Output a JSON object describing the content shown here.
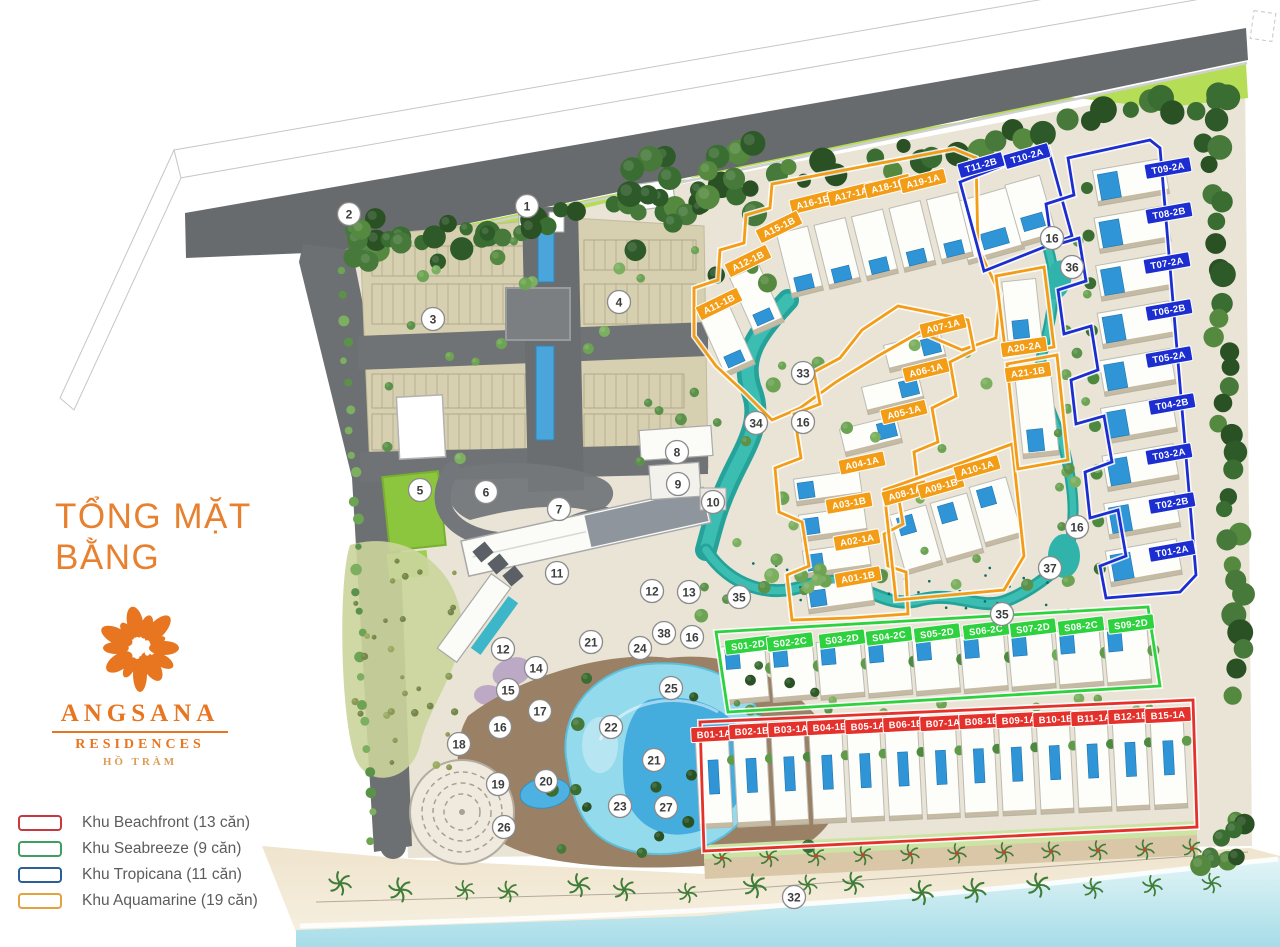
{
  "panel": {
    "title_lines": [
      "TỔNG MẶT",
      "BẰNG"
    ],
    "title_color": "#e8812f",
    "brand": {
      "name": "ANGSANA",
      "type": "RESIDENCES",
      "location": "HỒ TRÀM",
      "color": "#e8751f",
      "location_color": "#dd9c55"
    },
    "legend": [
      {
        "zone": "beachfront",
        "label": "Khu Beachfront (13 căn)",
        "color": "#c43a40"
      },
      {
        "zone": "seabreeze",
        "label": "Khu Seabreeze (9 căn)",
        "color": "#3f9e63"
      },
      {
        "zone": "tropicana",
        "label": "Khu Tropicana (11 căn)",
        "color": "#2d5f96"
      },
      {
        "zone": "aquamarine",
        "label": "Khu Aquamarine (19 căn)",
        "color": "#e2a23e"
      }
    ]
  },
  "map": {
    "zone_colors": {
      "beachfront": "#e5312b",
      "seabreeze": "#2ed13e",
      "tropicana": "#1c2ed0",
      "aquamarine": "#f39c15"
    },
    "units": [
      {
        "id": "A16-1B",
        "zone": "aquamarine",
        "x": 813,
        "y": 202,
        "r": -14
      },
      {
        "id": "A17-1A",
        "zone": "aquamarine",
        "x": 851,
        "y": 194,
        "r": -14
      },
      {
        "id": "A18-1B",
        "zone": "aquamarine",
        "x": 888,
        "y": 186,
        "r": -14
      },
      {
        "id": "A19-1A",
        "zone": "aquamarine",
        "x": 923,
        "y": 181,
        "r": -14
      },
      {
        "id": "A15-1B",
        "zone": "aquamarine",
        "x": 779,
        "y": 227,
        "r": -26
      },
      {
        "id": "A12-1B",
        "zone": "aquamarine",
        "x": 748,
        "y": 261,
        "r": -26
      },
      {
        "id": "A11-1B",
        "zone": "aquamarine",
        "x": 719,
        "y": 304,
        "r": -26
      },
      {
        "id": "A07-1A",
        "zone": "aquamarine",
        "x": 943,
        "y": 326,
        "r": -14
      },
      {
        "id": "A06-1A",
        "zone": "aquamarine",
        "x": 926,
        "y": 370,
        "r": -14
      },
      {
        "id": "A05-1A",
        "zone": "aquamarine",
        "x": 904,
        "y": 412,
        "r": -14
      },
      {
        "id": "A04-1A",
        "zone": "aquamarine",
        "x": 862,
        "y": 463,
        "r": -12
      },
      {
        "id": "A03-1B",
        "zone": "aquamarine",
        "x": 849,
        "y": 503,
        "r": -10
      },
      {
        "id": "A02-1A",
        "zone": "aquamarine",
        "x": 857,
        "y": 540,
        "r": -10
      },
      {
        "id": "A01-1B",
        "zone": "aquamarine",
        "x": 858,
        "y": 577,
        "r": -10
      },
      {
        "id": "A08-1A",
        "zone": "aquamarine",
        "x": 905,
        "y": 493,
        "r": -16
      },
      {
        "id": "A09-1B",
        "zone": "aquamarine",
        "x": 941,
        "y": 486,
        "r": -16
      },
      {
        "id": "A10-1A",
        "zone": "aquamarine",
        "x": 977,
        "y": 468,
        "r": -16
      },
      {
        "id": "A20-2A",
        "zone": "aquamarine",
        "x": 1024,
        "y": 347,
        "r": -8
      },
      {
        "id": "A21-1B",
        "zone": "aquamarine",
        "x": 1028,
        "y": 372,
        "r": -8
      },
      {
        "id": "T11-2B",
        "zone": "tropicana",
        "x": 981,
        "y": 165,
        "r": -16
      },
      {
        "id": "T10-2A",
        "zone": "tropicana",
        "x": 1027,
        "y": 156,
        "r": -16
      },
      {
        "id": "T09-2A",
        "zone": "tropicana",
        "x": 1168,
        "y": 168,
        "r": -10
      },
      {
        "id": "T08-2B",
        "zone": "tropicana",
        "x": 1169,
        "y": 213,
        "r": -10
      },
      {
        "id": "T07-2A",
        "zone": "tropicana",
        "x": 1167,
        "y": 263,
        "r": -10
      },
      {
        "id": "T06-2B",
        "zone": "tropicana",
        "x": 1169,
        "y": 310,
        "r": -10
      },
      {
        "id": "T05-2A",
        "zone": "tropicana",
        "x": 1169,
        "y": 357,
        "r": -10
      },
      {
        "id": "T04-2B",
        "zone": "tropicana",
        "x": 1172,
        "y": 404,
        "r": -10
      },
      {
        "id": "T03-2A",
        "zone": "tropicana",
        "x": 1169,
        "y": 454,
        "r": -10
      },
      {
        "id": "T02-2B",
        "zone": "tropicana",
        "x": 1172,
        "y": 503,
        "r": -10
      },
      {
        "id": "T01-2A",
        "zone": "tropicana",
        "x": 1172,
        "y": 551,
        "r": -10
      },
      {
        "id": "S01-2D",
        "zone": "seabreeze",
        "x": 748,
        "y": 645,
        "r": -7
      },
      {
        "id": "S02-2C",
        "zone": "seabreeze",
        "x": 790,
        "y": 642,
        "r": -7
      },
      {
        "id": "S03-2D",
        "zone": "seabreeze",
        "x": 842,
        "y": 639,
        "r": -7
      },
      {
        "id": "S04-2C",
        "zone": "seabreeze",
        "x": 889,
        "y": 636,
        "r": -7
      },
      {
        "id": "S05-2D",
        "zone": "seabreeze",
        "x": 937,
        "y": 633,
        "r": -7
      },
      {
        "id": "S06-2C",
        "zone": "seabreeze",
        "x": 986,
        "y": 630,
        "r": -7
      },
      {
        "id": "S07-2D",
        "zone": "seabreeze",
        "x": 1033,
        "y": 628,
        "r": -7
      },
      {
        "id": "S08-2C",
        "zone": "seabreeze",
        "x": 1081,
        "y": 626,
        "r": -7
      },
      {
        "id": "S09-2D",
        "zone": "seabreeze",
        "x": 1131,
        "y": 624,
        "r": -7
      },
      {
        "id": "B01-1A",
        "zone": "beachfront",
        "x": 714,
        "y": 734,
        "r": -3
      },
      {
        "id": "B02-1B",
        "zone": "beachfront",
        "x": 752,
        "y": 731,
        "r": -3
      },
      {
        "id": "B03-1A",
        "zone": "beachfront",
        "x": 791,
        "y": 729,
        "r": -3
      },
      {
        "id": "B04-1B",
        "zone": "beachfront",
        "x": 830,
        "y": 727,
        "r": -3
      },
      {
        "id": "B05-1A",
        "zone": "beachfront",
        "x": 868,
        "y": 726,
        "r": -3
      },
      {
        "id": "B06-1B",
        "zone": "beachfront",
        "x": 906,
        "y": 724,
        "r": -3
      },
      {
        "id": "B07-1A",
        "zone": "beachfront",
        "x": 943,
        "y": 723,
        "r": -3
      },
      {
        "id": "B08-1B",
        "zone": "beachfront",
        "x": 982,
        "y": 721,
        "r": -3
      },
      {
        "id": "B09-1A",
        "zone": "beachfront",
        "x": 1019,
        "y": 720,
        "r": -3
      },
      {
        "id": "B10-1B",
        "zone": "beachfront",
        "x": 1056,
        "y": 719,
        "r": -3
      },
      {
        "id": "B11-1A",
        "zone": "beachfront",
        "x": 1094,
        "y": 718,
        "r": -3
      },
      {
        "id": "B12-1B",
        "zone": "beachfront",
        "x": 1131,
        "y": 716,
        "r": -3
      },
      {
        "id": "B15-1A",
        "zone": "beachfront",
        "x": 1168,
        "y": 715,
        "r": -3
      }
    ],
    "markers": [
      {
        "n": "1",
        "x": 527,
        "y": 206
      },
      {
        "n": "2",
        "x": 349,
        "y": 214
      },
      {
        "n": "3",
        "x": 433,
        "y": 319
      },
      {
        "n": "4",
        "x": 619,
        "y": 302
      },
      {
        "n": "5",
        "x": 420,
        "y": 490
      },
      {
        "n": "6",
        "x": 486,
        "y": 492
      },
      {
        "n": "7",
        "x": 559,
        "y": 509
      },
      {
        "n": "8",
        "x": 677,
        "y": 452
      },
      {
        "n": "9",
        "x": 678,
        "y": 484
      },
      {
        "n": "10",
        "x": 713,
        "y": 502
      },
      {
        "n": "11",
        "x": 557,
        "y": 573
      },
      {
        "n": "12",
        "x": 652,
        "y": 591
      },
      {
        "n": "13",
        "x": 689,
        "y": 592
      },
      {
        "n": "35",
        "x": 739,
        "y": 597
      },
      {
        "n": "38",
        "x": 664,
        "y": 633
      },
      {
        "n": "16",
        "x": 692,
        "y": 637
      },
      {
        "n": "24",
        "x": 640,
        "y": 648
      },
      {
        "n": "21",
        "x": 591,
        "y": 642
      },
      {
        "n": "12",
        "x": 503,
        "y": 649
      },
      {
        "n": "14",
        "x": 536,
        "y": 668
      },
      {
        "n": "15",
        "x": 508,
        "y": 690
      },
      {
        "n": "25",
        "x": 671,
        "y": 688
      },
      {
        "n": "17",
        "x": 540,
        "y": 711
      },
      {
        "n": "16",
        "x": 500,
        "y": 727
      },
      {
        "n": "22",
        "x": 611,
        "y": 727
      },
      {
        "n": "18",
        "x": 459,
        "y": 744
      },
      {
        "n": "21",
        "x": 654,
        "y": 760
      },
      {
        "n": "20",
        "x": 546,
        "y": 781
      },
      {
        "n": "19",
        "x": 498,
        "y": 784
      },
      {
        "n": "23",
        "x": 620,
        "y": 806
      },
      {
        "n": "27",
        "x": 666,
        "y": 807
      },
      {
        "n": "26",
        "x": 504,
        "y": 827
      },
      {
        "n": "32",
        "x": 794,
        "y": 897
      },
      {
        "n": "33",
        "x": 803,
        "y": 373
      },
      {
        "n": "34",
        "x": 756,
        "y": 423
      },
      {
        "n": "16",
        "x": 803,
        "y": 422
      },
      {
        "n": "36",
        "x": 1072,
        "y": 267
      },
      {
        "n": "16",
        "x": 1052,
        "y": 238
      },
      {
        "n": "37",
        "x": 1050,
        "y": 568
      },
      {
        "n": "16",
        "x": 1077,
        "y": 527
      },
      {
        "n": "35",
        "x": 1002,
        "y": 614
      }
    ]
  }
}
